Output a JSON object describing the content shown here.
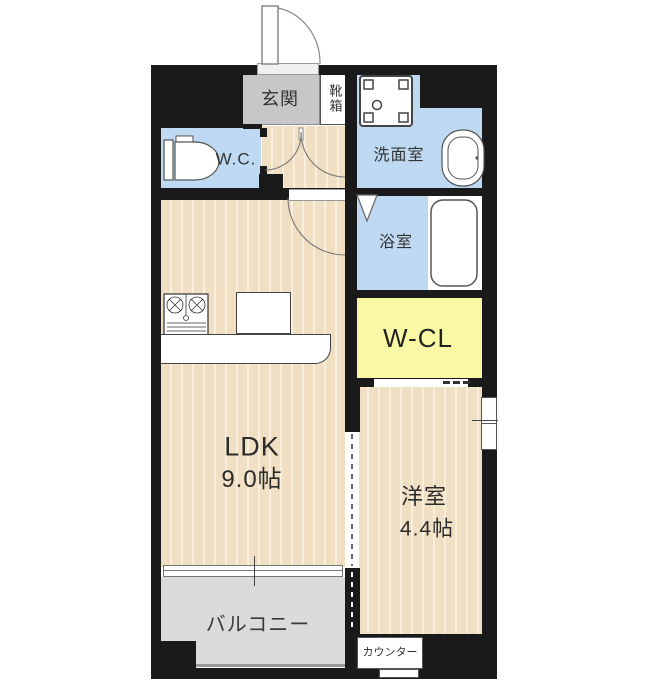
{
  "floor_plan": {
    "rooms": {
      "genkan": "玄関",
      "shoe_box": "靴箱",
      "wc": "W.C.",
      "washroom": "洗面室",
      "bathroom": "浴室",
      "walk_in_closet": "W-CL",
      "ldk_name": "LDK",
      "ldk_size": "9.0帖",
      "western_room_name": "洋室",
      "western_room_size": "4.4帖",
      "balcony": "バルコニー",
      "counter": "カウンター"
    },
    "colors": {
      "wall": "#1a1a1a",
      "water_area_blue": "#bed9f1",
      "flooring": "#f1dfc3",
      "flooring_stripe": "#f9efde",
      "closet_yellow": "#f9f9a5",
      "entrance_gray": "#c7c7c9",
      "balcony_gray": "#dbdbdd",
      "fixture_white": "#ffffff"
    },
    "icons": [
      "entrance-door-icon",
      "toilet-icon",
      "washing-machine-icon",
      "washbasin-icon",
      "bathtub-icon",
      "stove-icon",
      "kitchen-sink-icon",
      "door-swing-icon",
      "folding-door-icon",
      "sliding-window-icon",
      "sliding-partition-icon"
    ]
  }
}
